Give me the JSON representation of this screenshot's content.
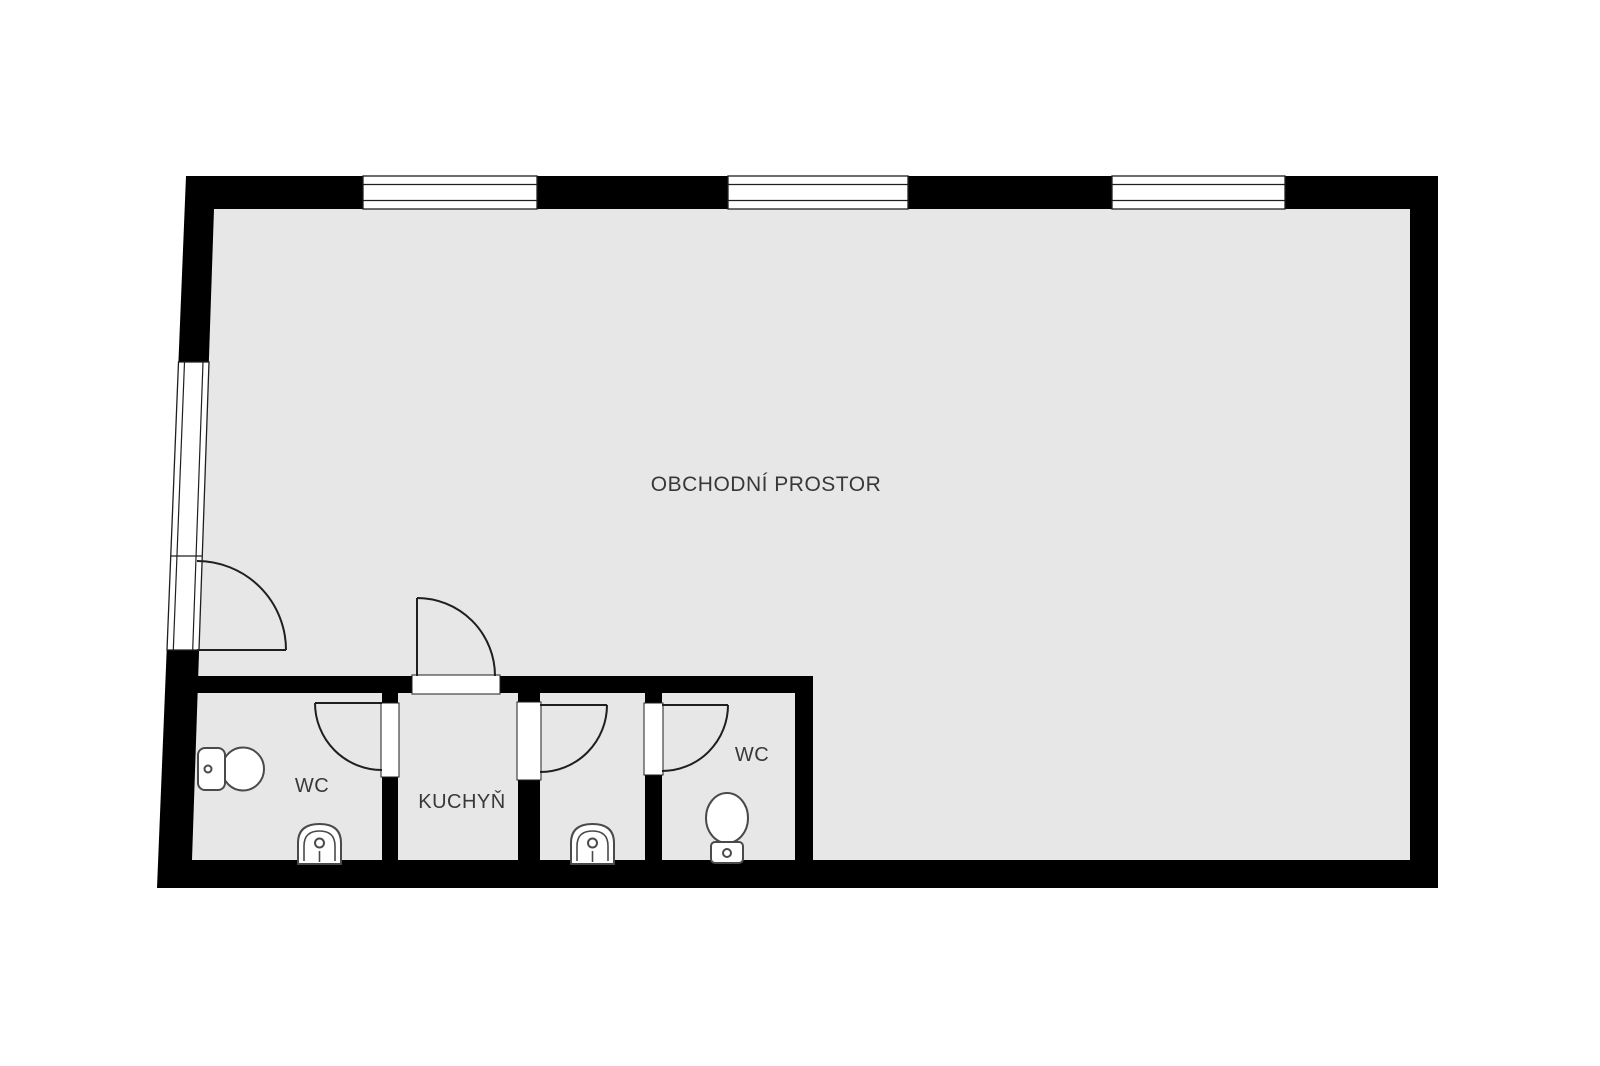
{
  "plan": {
    "type": "floor-plan",
    "rooms": {
      "main": {
        "label": "OBCHODNÍ PROSTOR"
      },
      "wc_left": {
        "label": "WC"
      },
      "kitchen": {
        "label": "KUCHYŇ"
      },
      "utility": {
        "label": ""
      },
      "wc_right": {
        "label": "WC"
      }
    },
    "fixtures": [
      "toilet-left-wc",
      "sink-left-wc",
      "sink-utility-room",
      "toilet-right-wc"
    ],
    "windows": {
      "top_wall_count": 3,
      "left_wall_count": 1
    },
    "doors": [
      "entrance-left-wall",
      "kitchen-door",
      "wc-left-door",
      "utility-door",
      "wc-right-door"
    ],
    "colors": {
      "wall": "#000000",
      "floor": "#e7e7e7",
      "background": "#ffffff",
      "line": "#1f1f1f",
      "text": "#383838"
    }
  }
}
